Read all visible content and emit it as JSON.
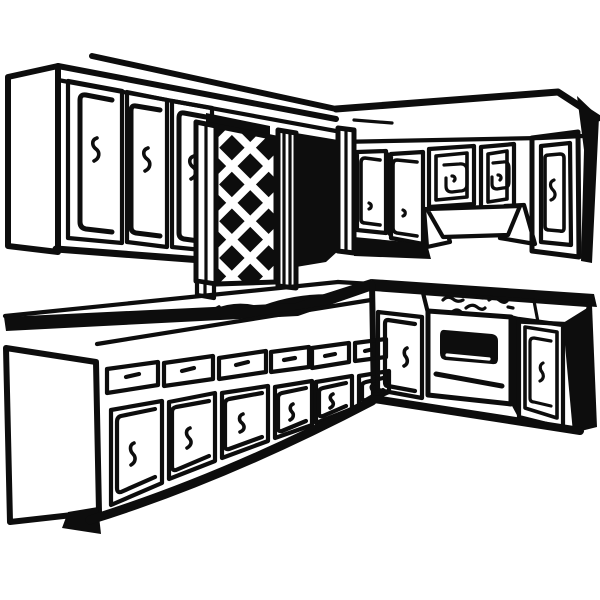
{
  "image": {
    "alt": "Black and white clip-art line drawing of a kitchen: L-shaped base cabinets with drawers, doors, a sink and a built-in oven with cooktop burners, upper wall cabinets with panel doors, a diamond-lattice cabinet insert and a range-hood valance."
  },
  "colors": {
    "ink": "#0d0d0d",
    "paper": "#ffffff"
  }
}
